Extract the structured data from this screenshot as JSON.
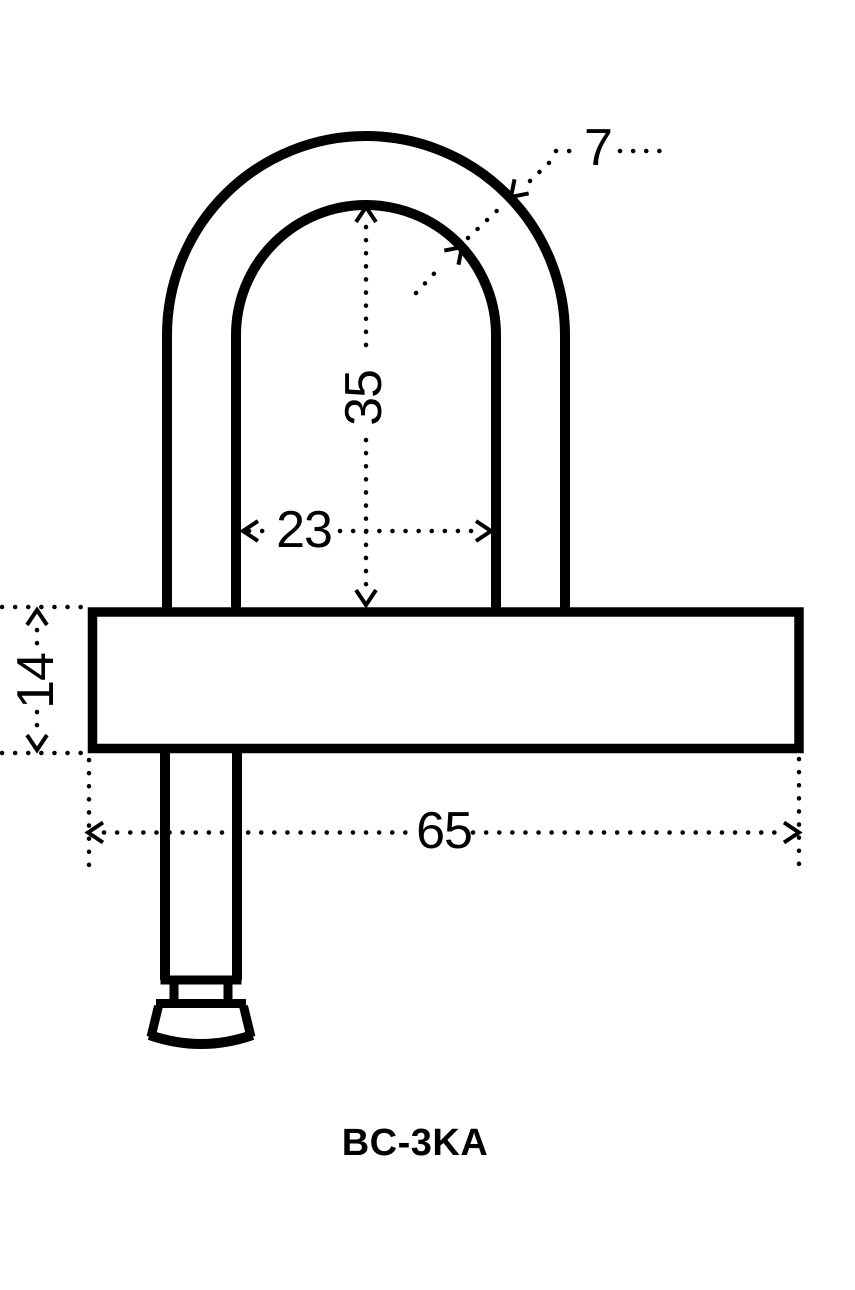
{
  "drawing": {
    "product_code": "BC-3KA",
    "type_note": "padlock outline drawing with dimensions",
    "dimensions": {
      "shackle_diameter": "7",
      "shackle_inner_height": "35",
      "shackle_inner_width": "23",
      "body_height": "14",
      "body_width": "65"
    },
    "line_color": "#000000",
    "background_color": "#ffffff"
  }
}
